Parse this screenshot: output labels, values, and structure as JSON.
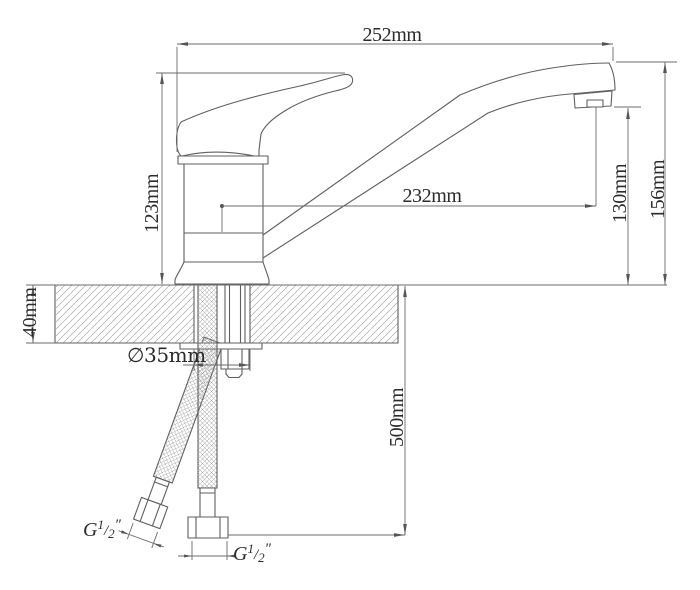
{
  "dimensions": {
    "total_length": "252mm",
    "body_height": "123mm",
    "spout_reach": "232mm",
    "spout_outlet_height": "130mm",
    "total_height": "156mm",
    "countertop_thickness": "40mm",
    "hole_diameter": "∅35mm",
    "hose_length": "500mm"
  },
  "thread_label": {
    "base": "G",
    "numerator": "1",
    "slash": "/",
    "denominator": "2",
    "prime": "″"
  }
}
